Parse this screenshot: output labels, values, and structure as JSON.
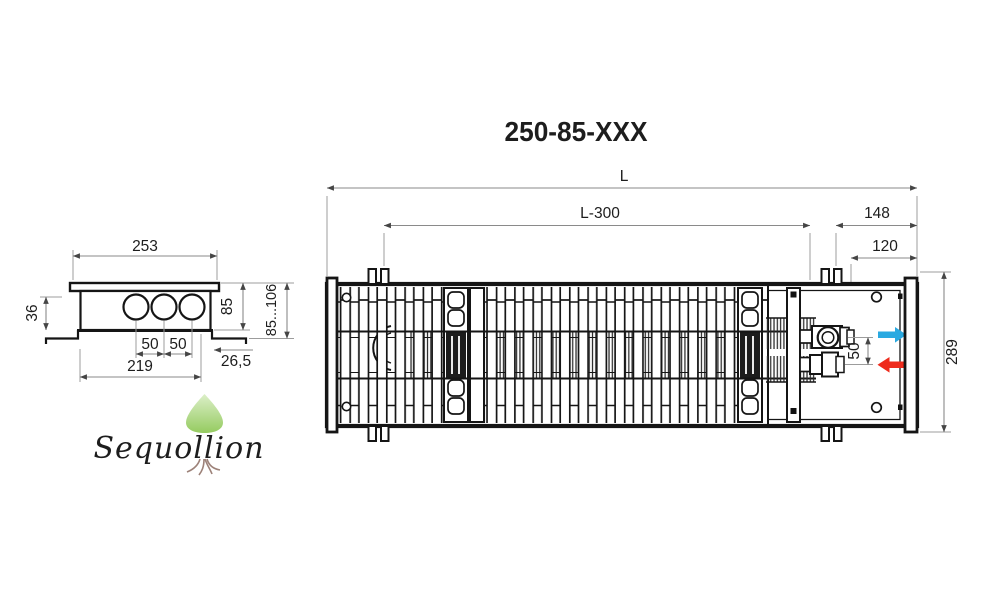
{
  "title": "250-85-XXX",
  "section_view": {
    "dim_width_top": "253",
    "dim_depth": "36",
    "dim_pipe_gap_a": "50",
    "dim_pipe_gap_b": "50",
    "dim_width_bottom": "219",
    "dim_flange_offset": "26,5",
    "dim_height_body": "85",
    "dim_height_trench": "85...106"
  },
  "top_view": {
    "dim_length": "L",
    "dim_grille_length": "L-300",
    "dim_end_block": "148",
    "dim_connection_inset": "120",
    "dim_width": "289",
    "dim_valve_spacing": "50"
  },
  "legend": {
    "flow_supply_color": "#29a9e1",
    "flow_return_color": "#ee2b1c"
  },
  "watermark": {
    "brand": "Sequollion",
    "tree_green": "#8cc63f",
    "text_color": "#9d8279"
  }
}
